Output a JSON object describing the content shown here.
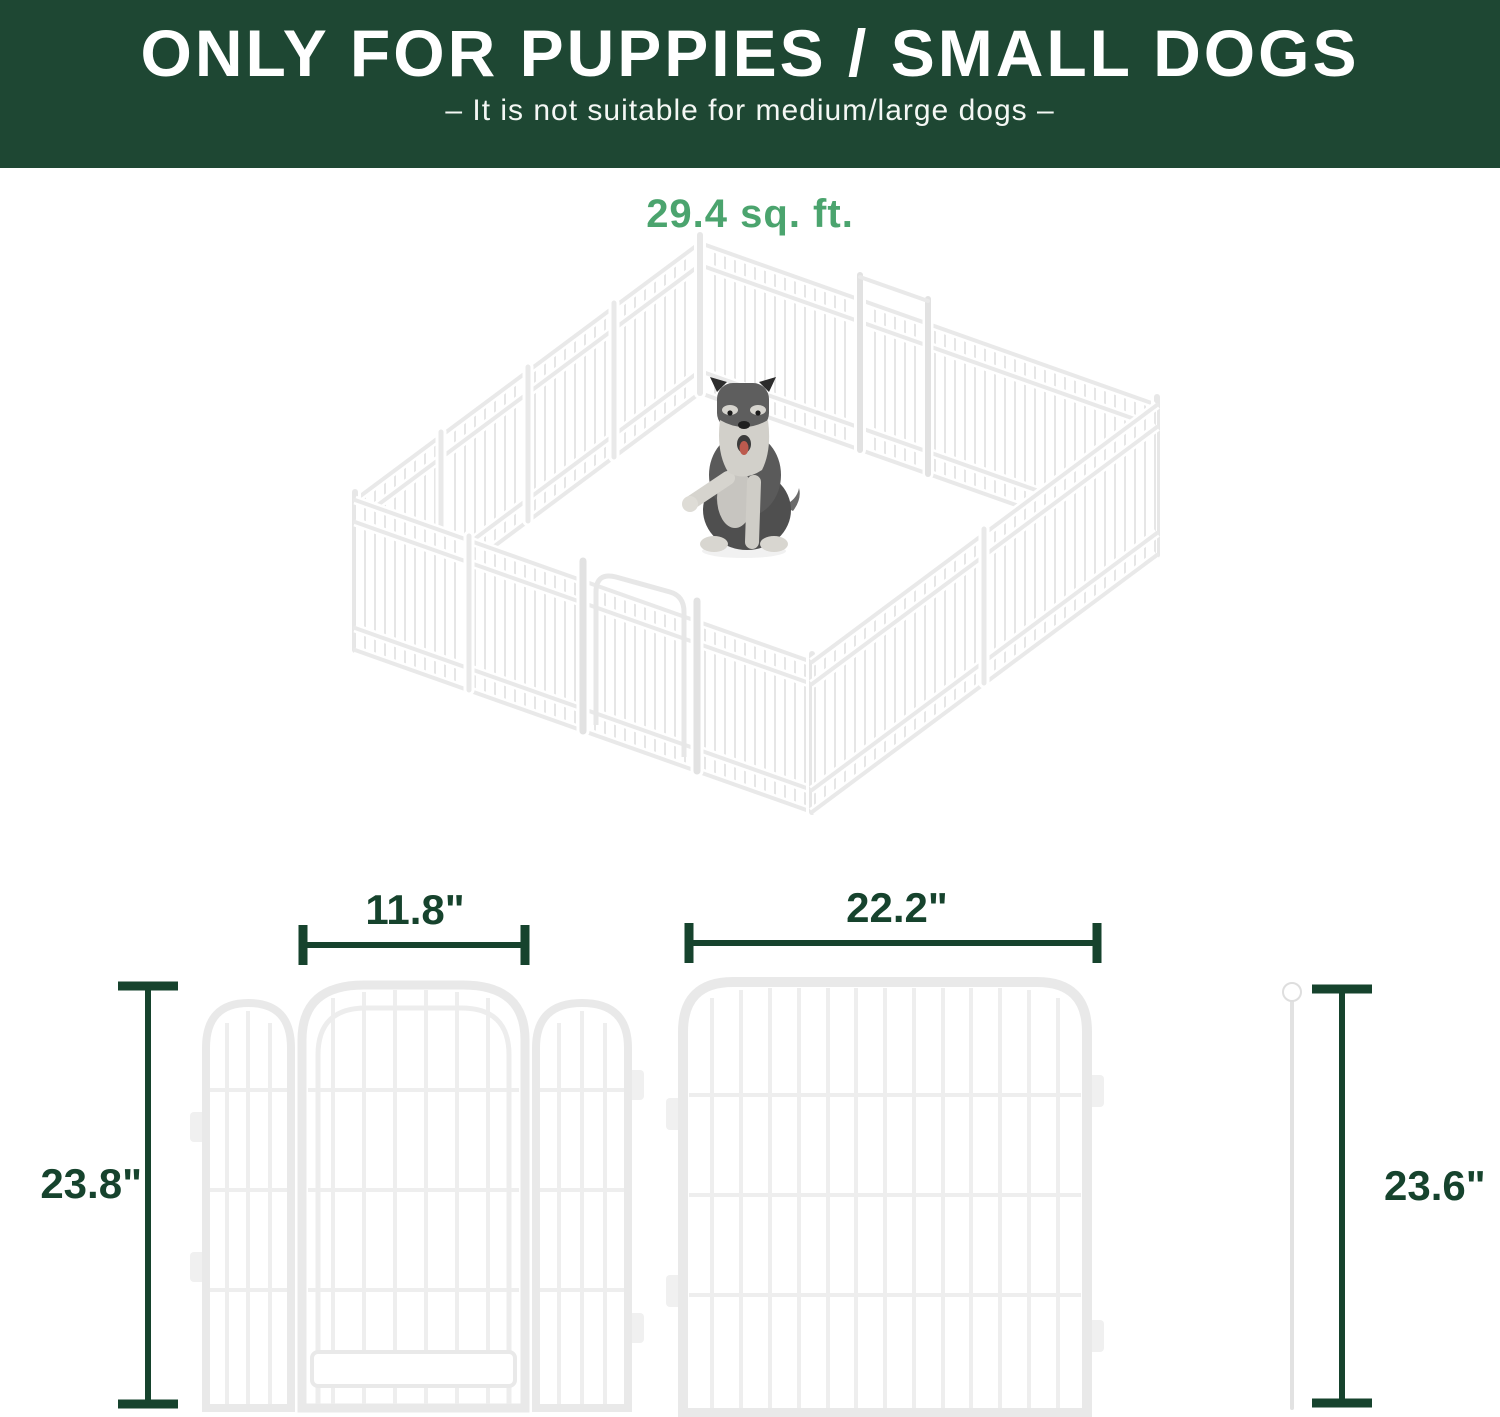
{
  "banner": {
    "title": "ONLY FOR PUPPIES / SMALL DOGS",
    "subtitle": "– It is not suitable for medium/large dogs –",
    "background_color": "#1e4733",
    "text_color": "#ffffff"
  },
  "area": {
    "label": "29.4 sq. ft.",
    "color": "#4ba46e"
  },
  "illustration": {
    "name": "playpen-with-dog",
    "panel_color": "#ffffff",
    "wire_color": "#e4e4e4"
  },
  "dimensions": {
    "line_color": "#16432d",
    "small_panel_width": "11.8\"",
    "large_panel_width": "22.2\"",
    "panel_height_left": "23.8\"",
    "rod_height_right": "23.6\""
  }
}
